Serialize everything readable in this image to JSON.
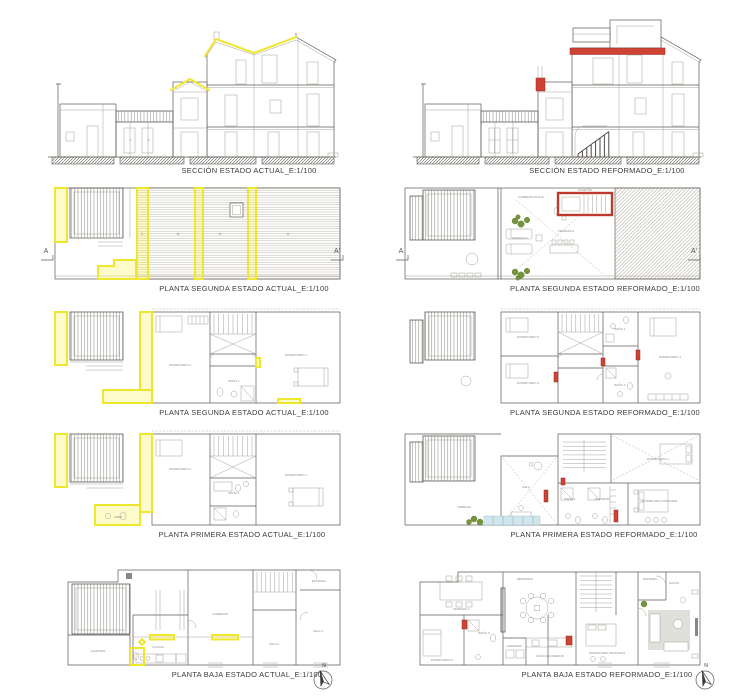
{
  "sheet_title": "Estado actual / estado reformado drawing sheet",
  "colors": {
    "demolition_yellow": "#efe72e",
    "new_work_red": "#cf4335",
    "plant_green": "#74953e",
    "water_blue": "#cfe6ef",
    "line_gray": "#5f5b55"
  },
  "panels": [
    {
      "id": "section-actual",
      "caption": "SECCIÓN ESTADO ACTUAL_E:1/100"
    },
    {
      "id": "section-reformado",
      "caption": "SECCIÓN ESTADO REFORMADO_E:1/100"
    },
    {
      "id": "roof-actual",
      "caption": "PLANTA SEGUNDA ESTADO ACTUAL_E:1/100",
      "marker_left": "A",
      "marker_right": "A'"
    },
    {
      "id": "roof-reformado",
      "caption": "PLANTA SEGUNDA ESTADO REFORMADO_E:1/100",
      "marker_left": "A",
      "marker_right": "A'",
      "labels": [
        {
          "text": "CASETÓN",
          "x": 187,
          "y": 9
        },
        {
          "text": "CUBIERTA PLANA",
          "x": 133,
          "y": 16
        },
        {
          "text": "TERRAZA 1",
          "x": 122,
          "y": 57
        },
        {
          "text": "TERRAZA 2",
          "x": 168,
          "y": 50
        }
      ]
    },
    {
      "id": "second-actual",
      "caption": "PLANTA SEGUNDA ESTADO ACTUAL_E:1/100",
      "labels": [
        {
          "text": "DORMITORIO 2",
          "x": 142,
          "y": 60
        },
        {
          "text": "BAÑO 1",
          "x": 196,
          "y": 76
        },
        {
          "text": "DORMITORIO 1",
          "x": 258,
          "y": 50
        }
      ]
    },
    {
      "id": "second-reformado",
      "caption": "PLANTA SEGUNDA ESTADO REFORMADO_E:1/100",
      "labels": [
        {
          "text": "DORMITORIO 2",
          "x": 130,
          "y": 32
        },
        {
          "text": "DORMITORIO 3",
          "x": 130,
          "y": 78
        },
        {
          "text": "BAÑO 1",
          "x": 222,
          "y": 24
        },
        {
          "text": "BAÑO 2",
          "x": 222,
          "y": 80
        },
        {
          "text": "DORMITORIO 1",
          "x": 272,
          "y": 52
        }
      ]
    },
    {
      "id": "first-actual",
      "caption": "PLANTA PRIMERA ESTADO ACTUAL_E:1/100",
      "labels": [
        {
          "text": "DORMITORIO 2",
          "x": 142,
          "y": 42
        },
        {
          "text": "BAÑO 1",
          "x": 196,
          "y": 66
        },
        {
          "text": "ASEO",
          "x": 80,
          "y": 90
        },
        {
          "text": "DORMITORIO 1",
          "x": 258,
          "y": 48
        }
      ]
    },
    {
      "id": "first-reformado",
      "caption": "PLANTA PRIMERA ESTADO REFORMADO_E:1/100",
      "labels": [
        {
          "text": "TERRAZA",
          "x": 66,
          "y": 80
        },
        {
          "text": "SALA",
          "x": 128,
          "y": 60
        },
        {
          "text": "BAÑO 1",
          "x": 172,
          "y": 72
        },
        {
          "text": "VESTIDOR",
          "x": 204,
          "y": 72
        },
        {
          "text": "DORMITORIO 1",
          "x": 260,
          "y": 32
        },
        {
          "text": "DORMITORIO PRINCIPAL",
          "x": 262,
          "y": 74
        }
      ]
    },
    {
      "id": "ground-actual",
      "caption": "PLANTA BAJA ESTADO ACTUAL_E:1/100",
      "compass": "N",
      "labels": [
        {
          "text": "ALMACÉN",
          "x": 60,
          "y": 92
        },
        {
          "text": "COCINA",
          "x": 120,
          "y": 88
        },
        {
          "text": "COMEDOR",
          "x": 182,
          "y": 55
        },
        {
          "text": "SALA 2",
          "x": 236,
          "y": 85
        },
        {
          "text": "SALA 1",
          "x": 280,
          "y": 72
        },
        {
          "text": "ENTRADA",
          "x": 281,
          "y": 22
        }
      ]
    },
    {
      "id": "ground-reformado",
      "caption": "PLANTA BAJA ESTADO REFORMADO_E:1/100",
      "compass": "N",
      "labels": [
        {
          "text": "TERRAZA 1",
          "x": 63,
          "y": 50
        },
        {
          "text": "DORMITORIO 4",
          "x": 44,
          "y": 101
        },
        {
          "text": "BAÑO 3",
          "x": 86,
          "y": 74
        },
        {
          "text": "LAVADERO",
          "x": 116,
          "y": 87
        },
        {
          "text": "DESPENSA",
          "x": 127,
          "y": 20
        },
        {
          "text": "COCINA COMEDOR",
          "x": 152,
          "y": 97
        },
        {
          "text": "DORMITORIO INVITADOS",
          "x": 209,
          "y": 94
        },
        {
          "text": "ENTRADA",
          "x": 252,
          "y": 20
        },
        {
          "text": "SALÓN",
          "x": 276,
          "y": 24
        }
      ]
    }
  ]
}
